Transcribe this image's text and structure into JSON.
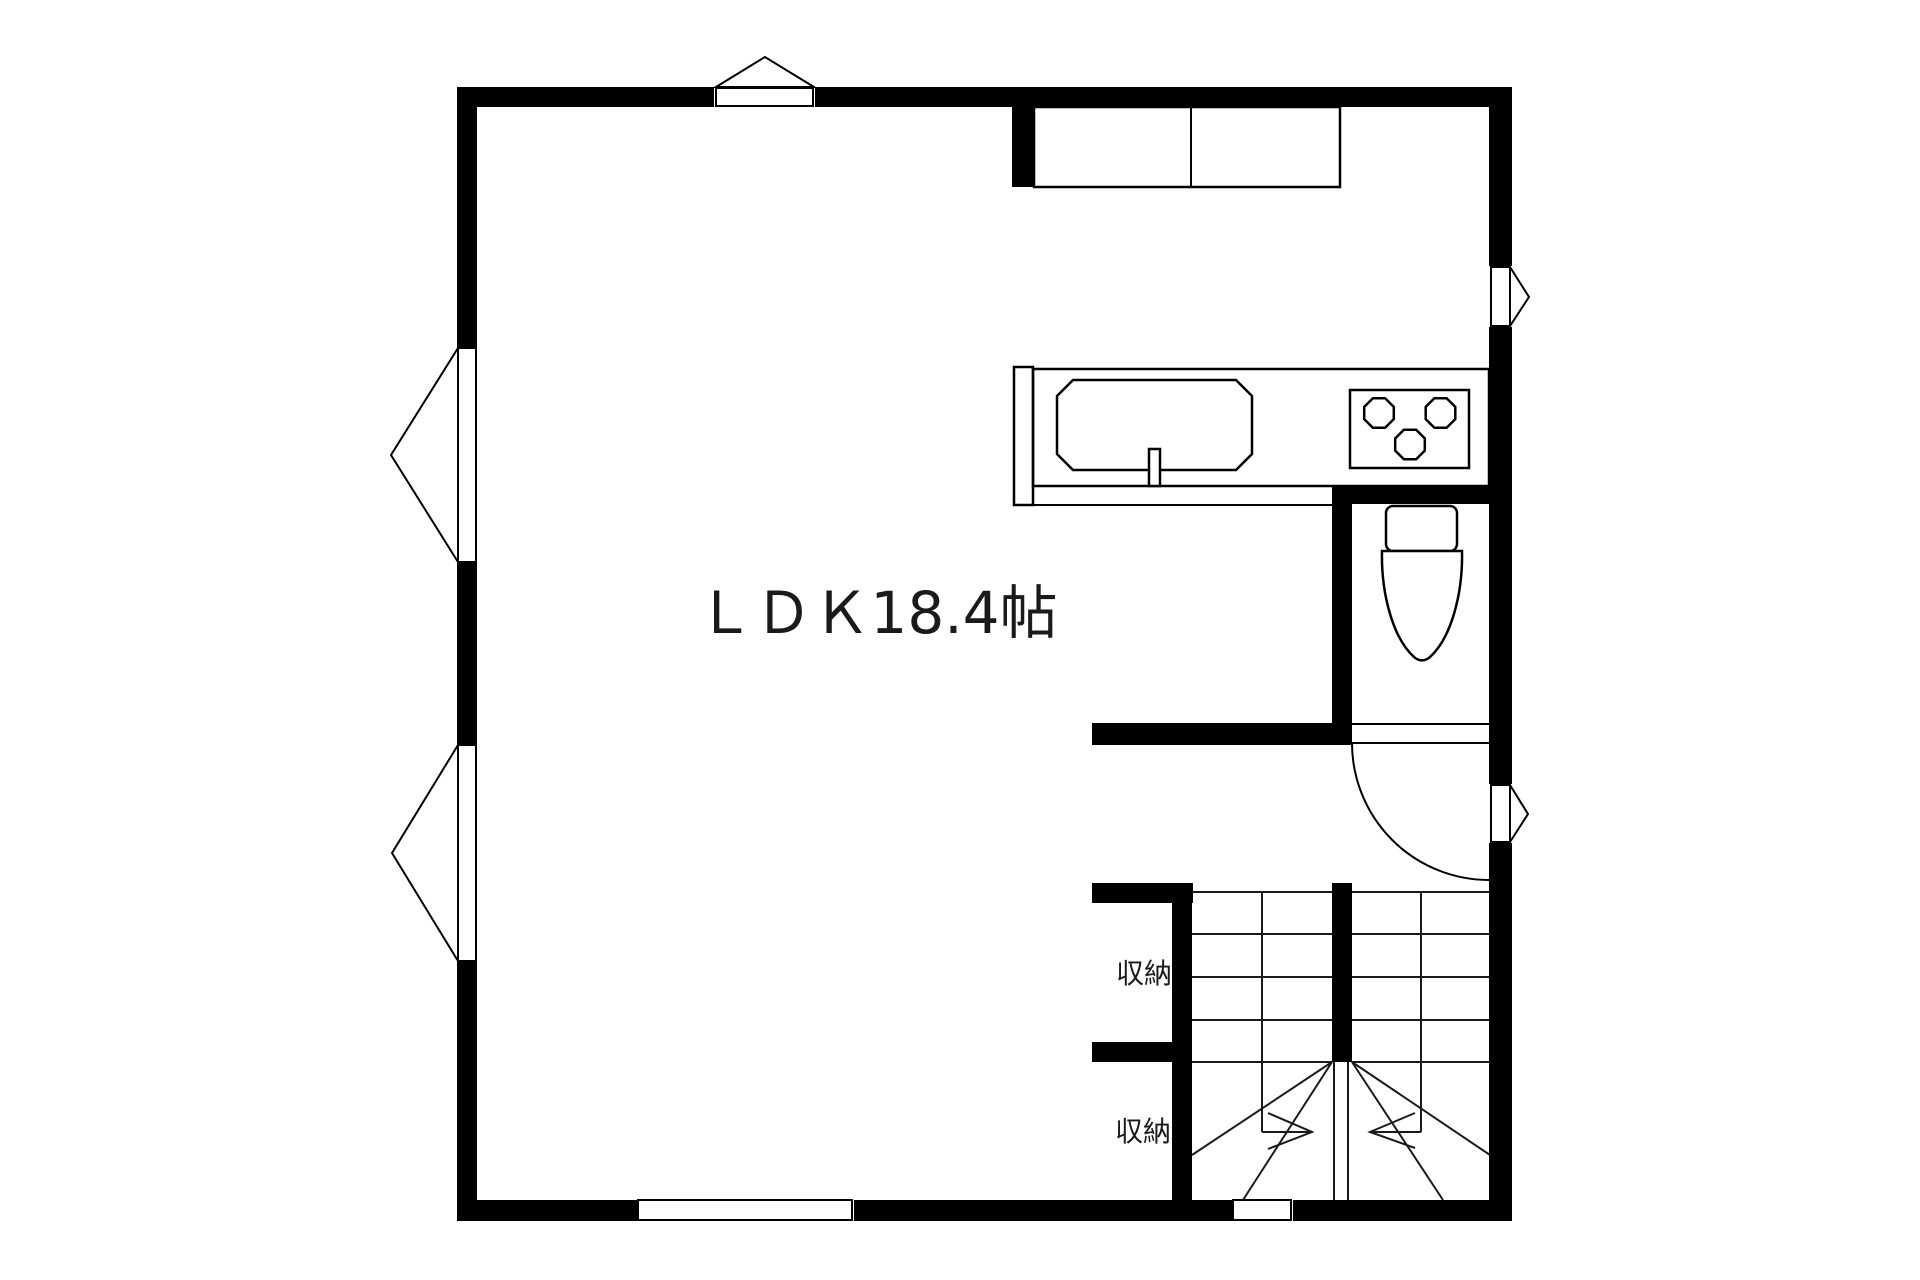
{
  "floorplan": {
    "rooms": [
      {
        "id": "ldk",
        "label": "ＬＤＫ18.4帖",
        "name": "living-dining-kitchen",
        "area_tatami": "18.4"
      },
      {
        "id": "storage-upper",
        "label": "収納",
        "name": "storage-closet"
      },
      {
        "id": "storage-lower",
        "label": "収納",
        "name": "storage-closet"
      }
    ],
    "fixtures": [
      "wall-cabinet-icon",
      "kitchen-counter-icon",
      "kitchen-sink-icon",
      "faucet-icon",
      "gas-stove-three-burner-icon",
      "toilet-icon",
      "door-swing-arc-icon",
      "staircase-u-shape-icon",
      "stair-direction-arrow-icon"
    ],
    "windows": [
      "top-casement-window",
      "left-casement-window-upper",
      "left-casement-window-lower",
      "right-casement-window-upper",
      "right-casement-window-lower",
      "bottom-sliding-window",
      "bottom-stair-opening"
    ],
    "colors": {
      "wall": "#000000",
      "floor": "#ffffff",
      "line": "#000000"
    }
  }
}
